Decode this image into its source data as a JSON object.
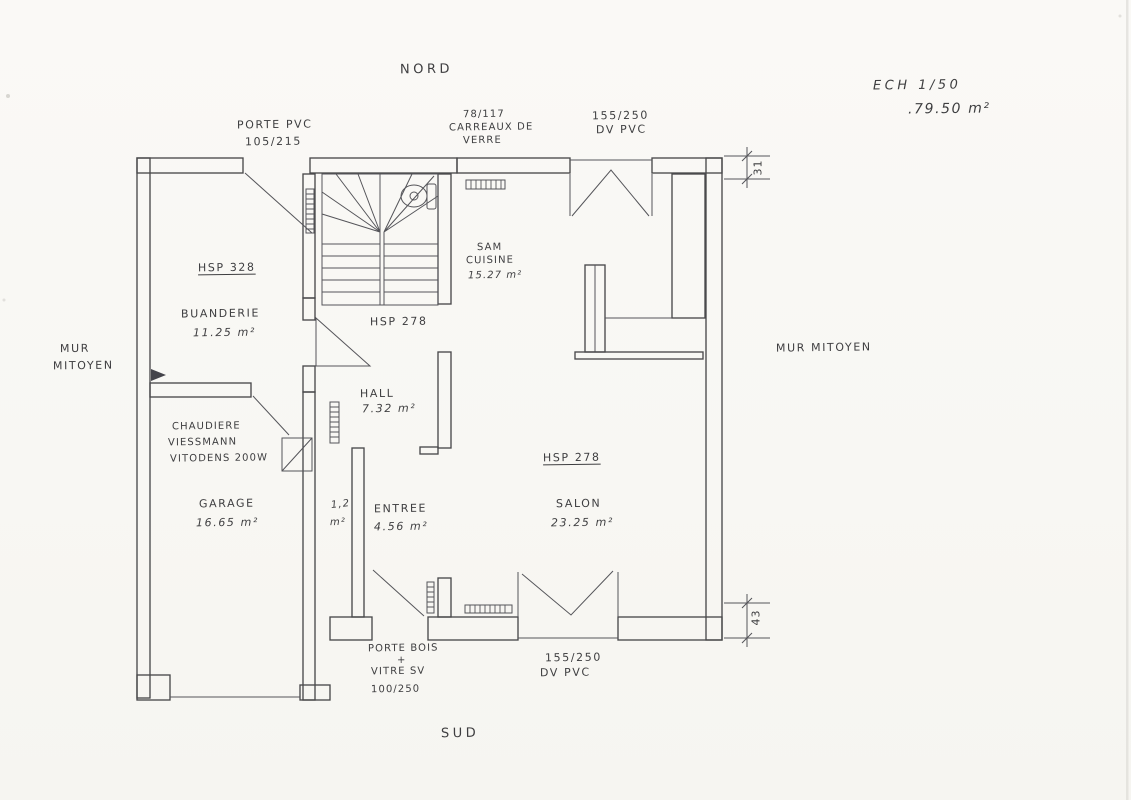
{
  "header": {
    "north": "NORD",
    "south": "SUD",
    "scale": "ECH  1/50",
    "total_area": ".79.50 m²"
  },
  "party_walls": {
    "left_line1": "MUR",
    "left_line2": "MITOYEN",
    "right": "MUR  MITOYEN"
  },
  "openings": {
    "porte_pvc_line1": "PORTE PVC",
    "porte_pvc_line2": "105/215",
    "glass_line1": "78/117",
    "glass_line2": "CARREAUX DE",
    "glass_line3": "VERRE",
    "window_north_line1": "155/250",
    "window_north_line2": "DV PVC",
    "window_south_line1": "155/250",
    "window_south_line2": "DV  PVC",
    "entry_door_line1": "PORTE BOIS",
    "entry_door_line2": "+",
    "entry_door_line3": "VITRE SV",
    "entry_door_line4": "100/250"
  },
  "rooms": {
    "buanderie": {
      "hsp": "HSP 328",
      "name": "BUANDERIE",
      "area": "11.25 m²"
    },
    "hall": {
      "hsp": "HSP 278",
      "name": "HALL",
      "area": "7.32 m²"
    },
    "sam": {
      "name_line1": "SAM",
      "name_line2": "CUISINE",
      "area": "15.27 m²"
    },
    "salon": {
      "hsp": "HSP 278",
      "name": "SALON",
      "area": "23.25 m²"
    },
    "garage": {
      "name": "GARAGE",
      "area": "16.65 m²"
    },
    "entree": {
      "name": "ENTREE",
      "area": "4.56 m²"
    },
    "wc": {
      "area_line1": "1,2",
      "area_line2": "m²"
    },
    "chaudiere": {
      "line1": "CHAUDIERE",
      "line2": "VIESSMANN",
      "line3": "VITODENS 200W"
    }
  },
  "dimensions": {
    "top_right": "31",
    "bottom_right": "43"
  }
}
